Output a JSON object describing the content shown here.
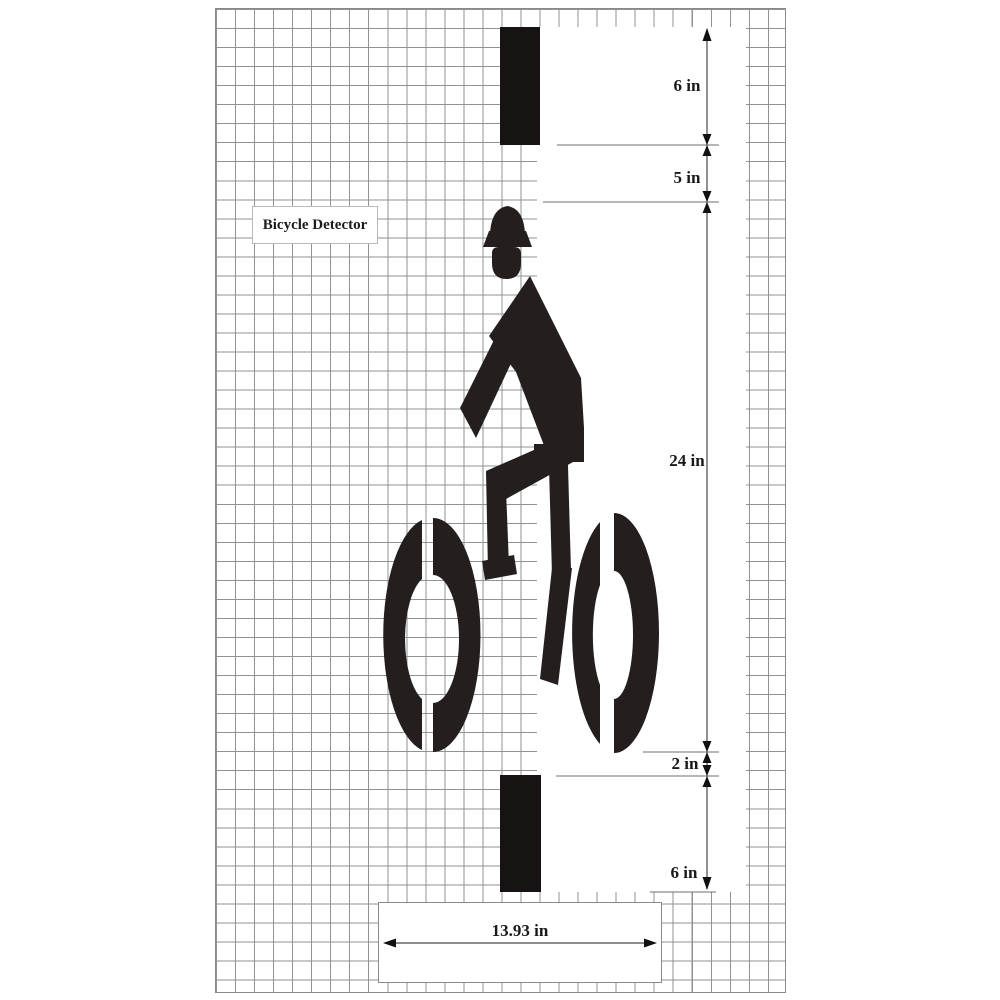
{
  "drawing": {
    "title_label": "Bicycle Detector",
    "dimensions": {
      "top_bar_length": "6 in",
      "bar_to_helmet_gap": "5 in",
      "symbol_height": "24 in",
      "wheel_to_bar_gap": "2 in",
      "bottom_bar_length": "6 in",
      "symbol_width": "13.93 in"
    },
    "symbol": "bicycle-rider-stencil",
    "colors": {
      "stencil_black": "#241f1e",
      "grid_line_gray": "#929292",
      "dimension_line_gray": "#474747",
      "background": "#ffffff"
    }
  }
}
